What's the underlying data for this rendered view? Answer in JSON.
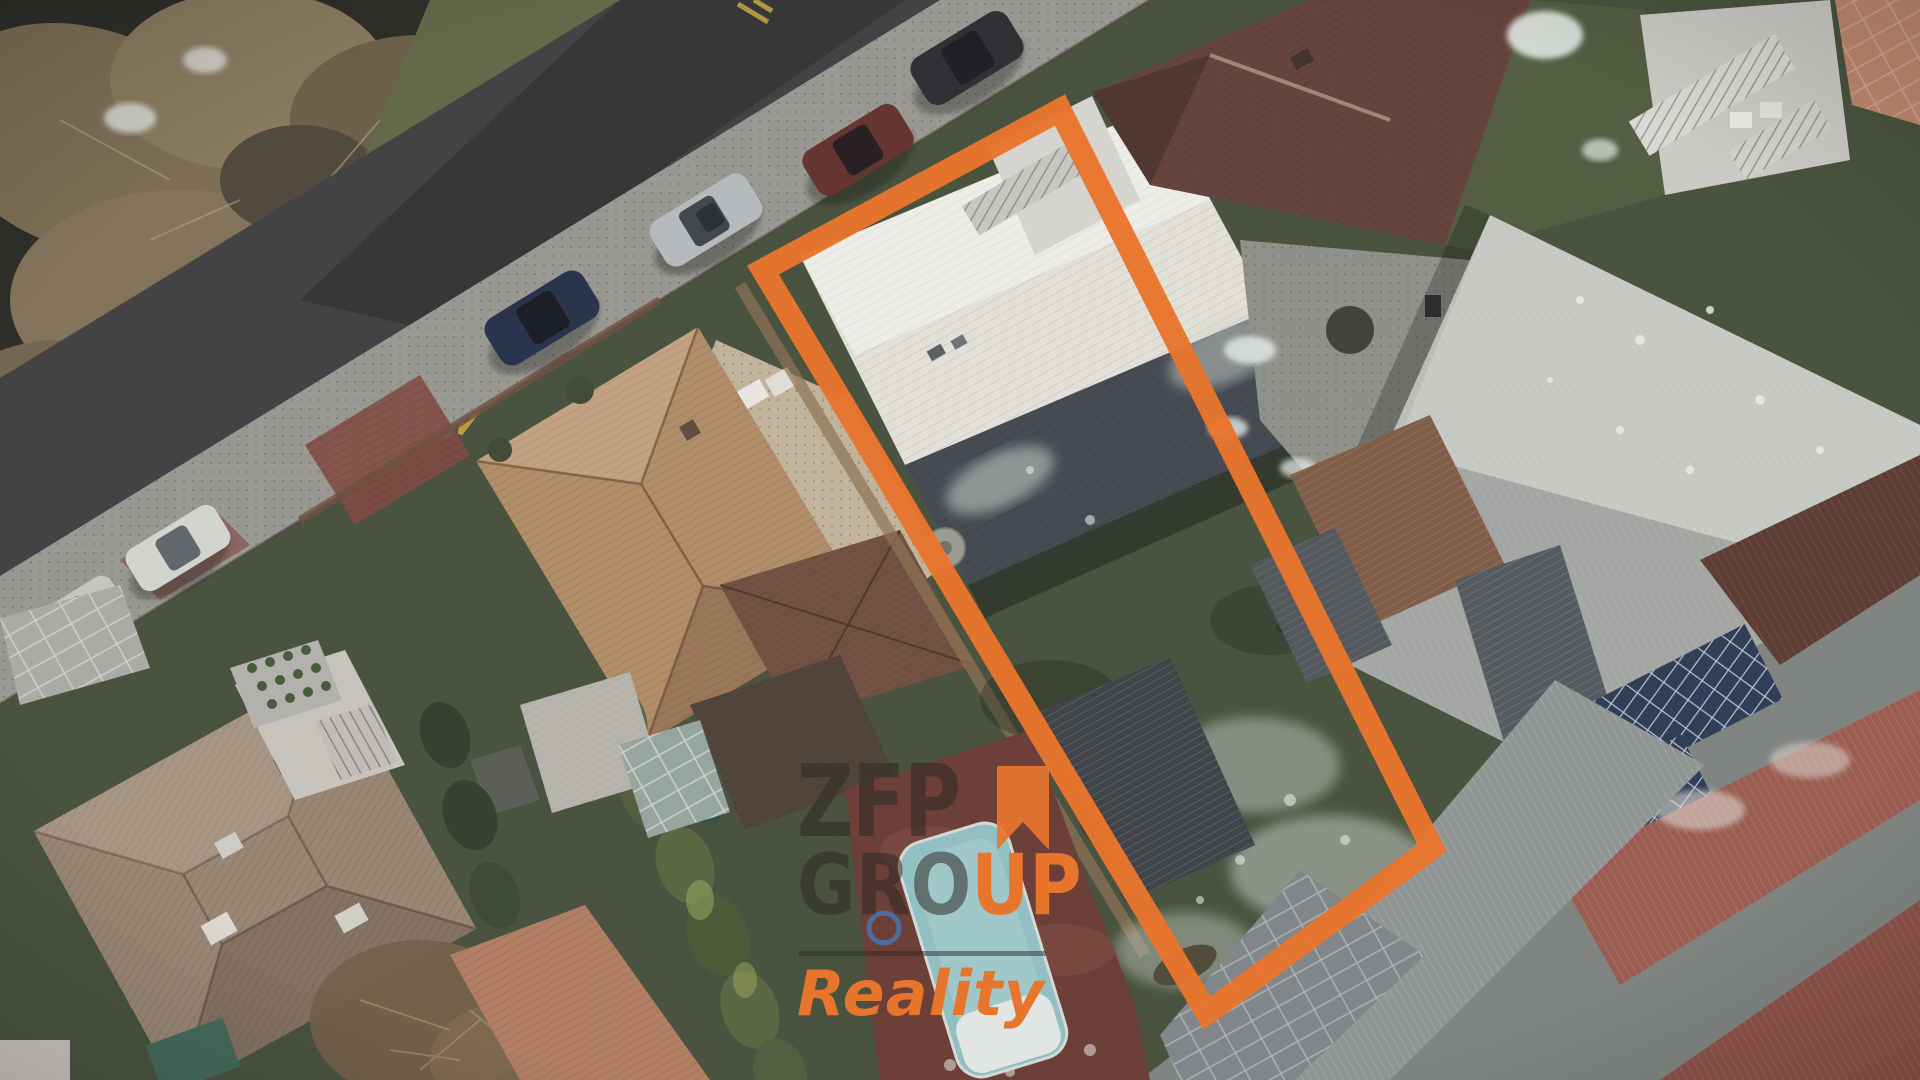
{
  "watermark": {
    "line1": "ZFP",
    "line2_dark": "GRO",
    "line2_accent": "UP",
    "line3": "Reality",
    "accent_color": "#E8752C",
    "dark_color": "rgba(45,42,38,0.55)",
    "rule_color": "rgba(45,42,38,0.5)"
  },
  "boundary": {
    "points": "763,270 1060,110 1432,848 1207,1013",
    "color": "#E8752C",
    "width": "23"
  },
  "palette": {
    "lawn": "#414b35",
    "road": "#3a3a3c",
    "sidewalk": "#97968f",
    "creek_woods": "#23241e",
    "grass_bank": "#5b6440",
    "subject_roof_white": "#e7e4da",
    "subject_roof_dark": "#3e434b",
    "house_roof_tan": "#b28a64",
    "house_roof_brown": "#6e4a3a",
    "neighbor_roof_red": "#5f3c33",
    "warehouse_roof": "#b9bcb7",
    "pool_water": "#8fc0c2",
    "pool_deck": "#66352e",
    "solar_panel": "#253450",
    "greenhouse_gray": "#8e9290",
    "red_corrugated": "#99564a",
    "bottom_left_roof": "#97836f",
    "salmon_roof": "#b27a5e",
    "snow": "#e9ece8",
    "crosswalk_red": "#7c453c",
    "road_marking_yellow": "#c9a43a",
    "hedge_green": "#55613b",
    "slate_garage": "#373b40",
    "courtyard_tan": "#c3b49a"
  },
  "vehicles": [
    {
      "label": "dark parked car",
      "color": "#24262b"
    },
    {
      "label": "dark red parked car",
      "color": "#5f2b28"
    },
    {
      "label": "silver parked car",
      "color": "#b7babc"
    },
    {
      "label": "dark blue parked car",
      "color": "#1f2a44"
    },
    {
      "label": "white parked car",
      "color": "#d4d6d2"
    },
    {
      "label": "white parked car",
      "color": "#c4c7c3"
    }
  ]
}
